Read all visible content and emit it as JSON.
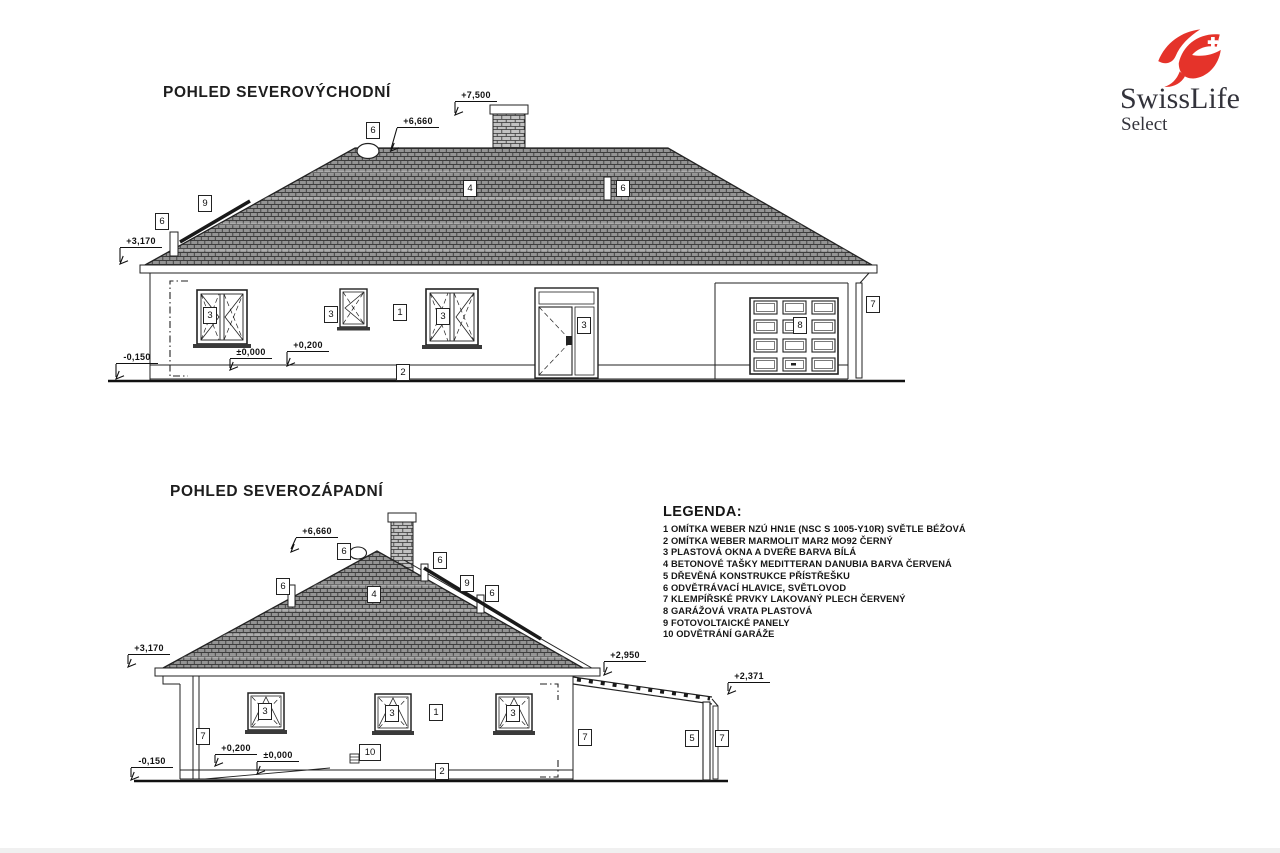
{
  "logo": {
    "brand": "SwissLife",
    "sub": "Select",
    "red": "#e5332a",
    "text_color": "#33333b"
  },
  "views": [
    {
      "title": "POHLED SEVEROVÝCHODNÍ",
      "levels": [
        "+7,500",
        "+6,660",
        "+3,170",
        "-0,150",
        "±0,000",
        "+0,200"
      ],
      "markers": [
        "6",
        "9",
        "6",
        "4",
        "6",
        "3",
        "3",
        "1",
        "3",
        "3",
        "8",
        "7",
        "2"
      ]
    },
    {
      "title": "POHLED SEVEROZÁPADNÍ",
      "levels": [
        "+6,660",
        "+3,170",
        "-0,150",
        "+0,200",
        "±0,000",
        "+2,950",
        "+2,371"
      ],
      "markers": [
        "6",
        "6",
        "4",
        "6",
        "9",
        "6",
        "3",
        "3",
        "1",
        "3",
        "7",
        "10",
        "2",
        "7",
        "5",
        "7"
      ]
    }
  ],
  "legend": {
    "title": "LEGENDA:",
    "items": [
      "1 OMÍTKA WEBER NZÚ HN1E (NSC S 1005-Y10R) SVĚTLE BÉŽOVÁ",
      "2 OMÍTKA WEBER MARMOLIT MAR2 MO92 ČERNÝ",
      "3 PLASTOVÁ OKNA A DVEŘE BARVA BÍLÁ",
      "4 BETONOVÉ TAŠKY MEDITTERAN DANUBIA BARVA ČERVENÁ",
      "5 DŘEVĚNÁ KONSTRUKCE PŘÍSTŘEŠKU",
      "6 ODVĚTRÁVACÍ HLAVICE, SVĚTLOVOD",
      "7 KLEMPÍŘSKÉ PRVKY LAKOVANÝ PLECH ČERVENÝ",
      "8 GARÁŽOVÁ VRATA PLASTOVÁ",
      "9 FOTOVOLTAICKÉ PANELY",
      "10 ODVĚTRÁNÍ GARÁŽE"
    ]
  },
  "colors": {
    "line": "#222222",
    "roof_fill": "#949494"
  }
}
